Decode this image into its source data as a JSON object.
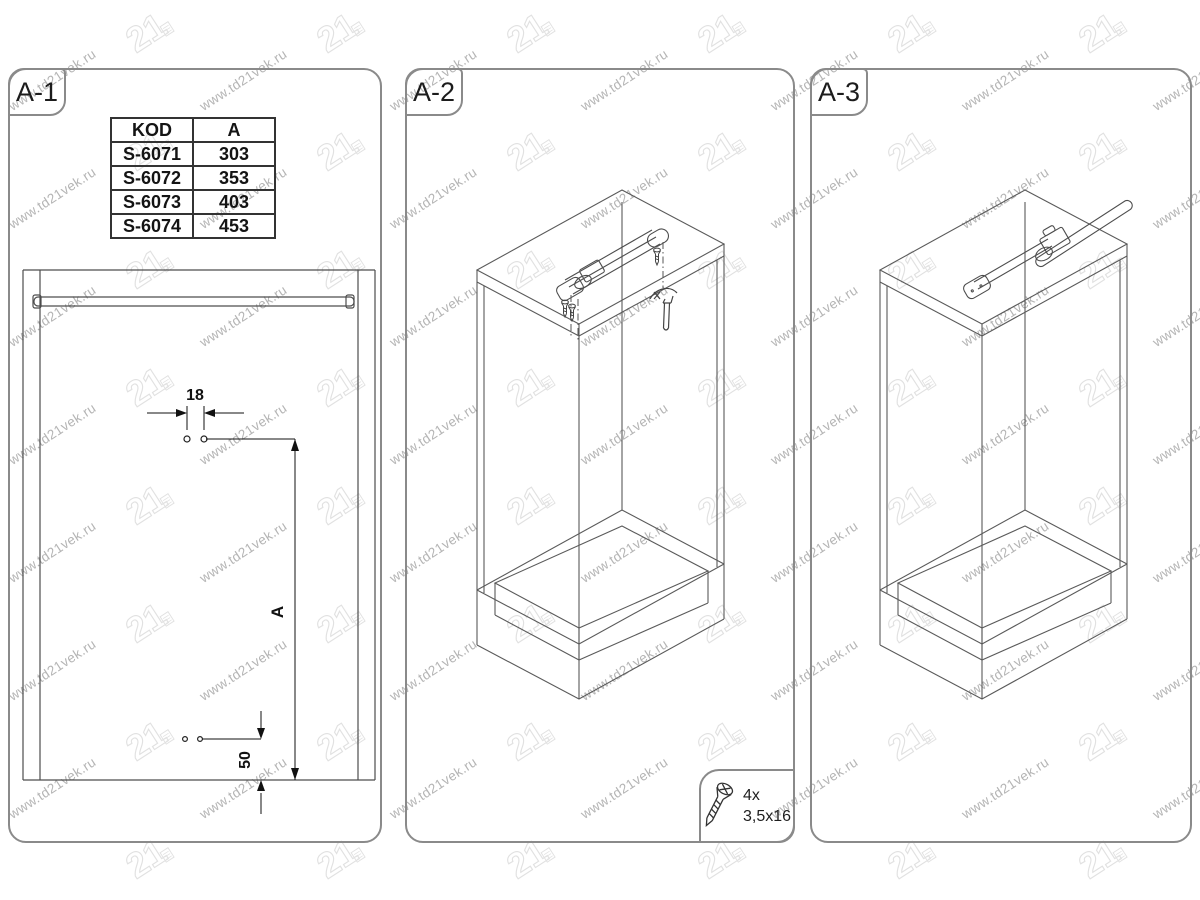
{
  "sheet": {
    "panel_border_color": "#8a8a8a",
    "line_color": "#555555",
    "dim_color": "#111111"
  },
  "watermark": {
    "text": "www.td21vek.ru",
    "logo_text": "21",
    "text_color": "#b4b4b4",
    "logo_color": "#e1e1e1"
  },
  "panels": [
    {
      "label": "A-1"
    },
    {
      "label": "A-2"
    },
    {
      "label": "A-3"
    }
  ],
  "size_table": {
    "headers": [
      "KOD",
      "A"
    ],
    "rows": [
      [
        "S-6071",
        "303"
      ],
      [
        "S-6072",
        "353"
      ],
      [
        "S-6073",
        "403"
      ],
      [
        "S-6074",
        "453"
      ]
    ]
  },
  "a1_dims": {
    "hole_spacing": "18",
    "height_ref": "A",
    "bottom_offset": "50"
  },
  "screw_callout": {
    "count": "4x",
    "size": "3,5x16"
  }
}
